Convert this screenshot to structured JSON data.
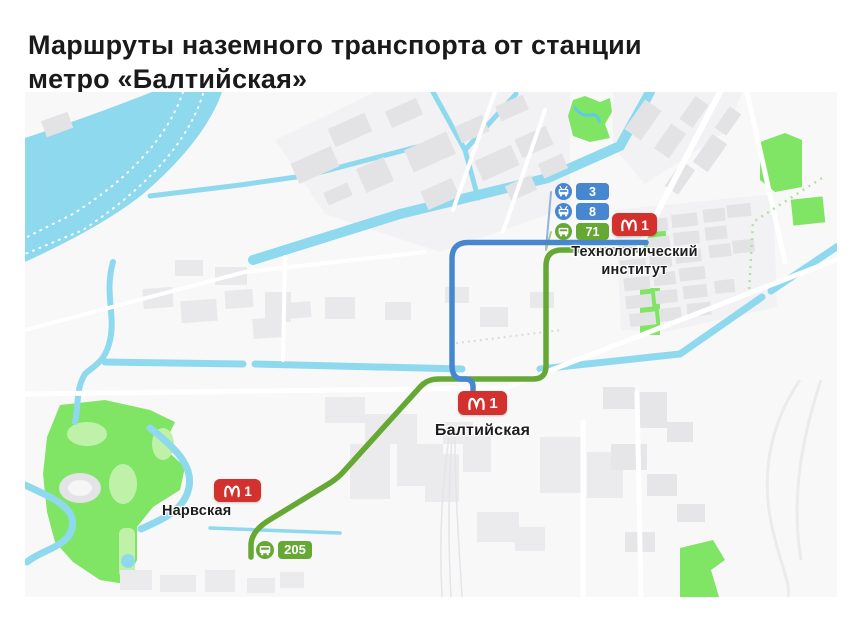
{
  "title": {
    "line1": "Маршруты наземного транспорта от станции",
    "line2": "метро «Балтийская»"
  },
  "colors": {
    "route_blue": "#4787CF",
    "route_green": "#65A934",
    "metro_red": "#D3312E",
    "water": "#8FD9EF",
    "park": "#80E565"
  },
  "map": {
    "stations": [
      {
        "name": "Технологический институт",
        "line_number": "1"
      },
      {
        "name": "Балтийская",
        "line_number": "1"
      },
      {
        "name": "Нарвская",
        "line_number": "1"
      }
    ],
    "route_badges": [
      {
        "number": "3",
        "type": "trolleybus"
      },
      {
        "number": "8",
        "type": "trolleybus"
      },
      {
        "number": "71",
        "type": "bus"
      },
      {
        "number": "205",
        "type": "bus"
      }
    ]
  }
}
